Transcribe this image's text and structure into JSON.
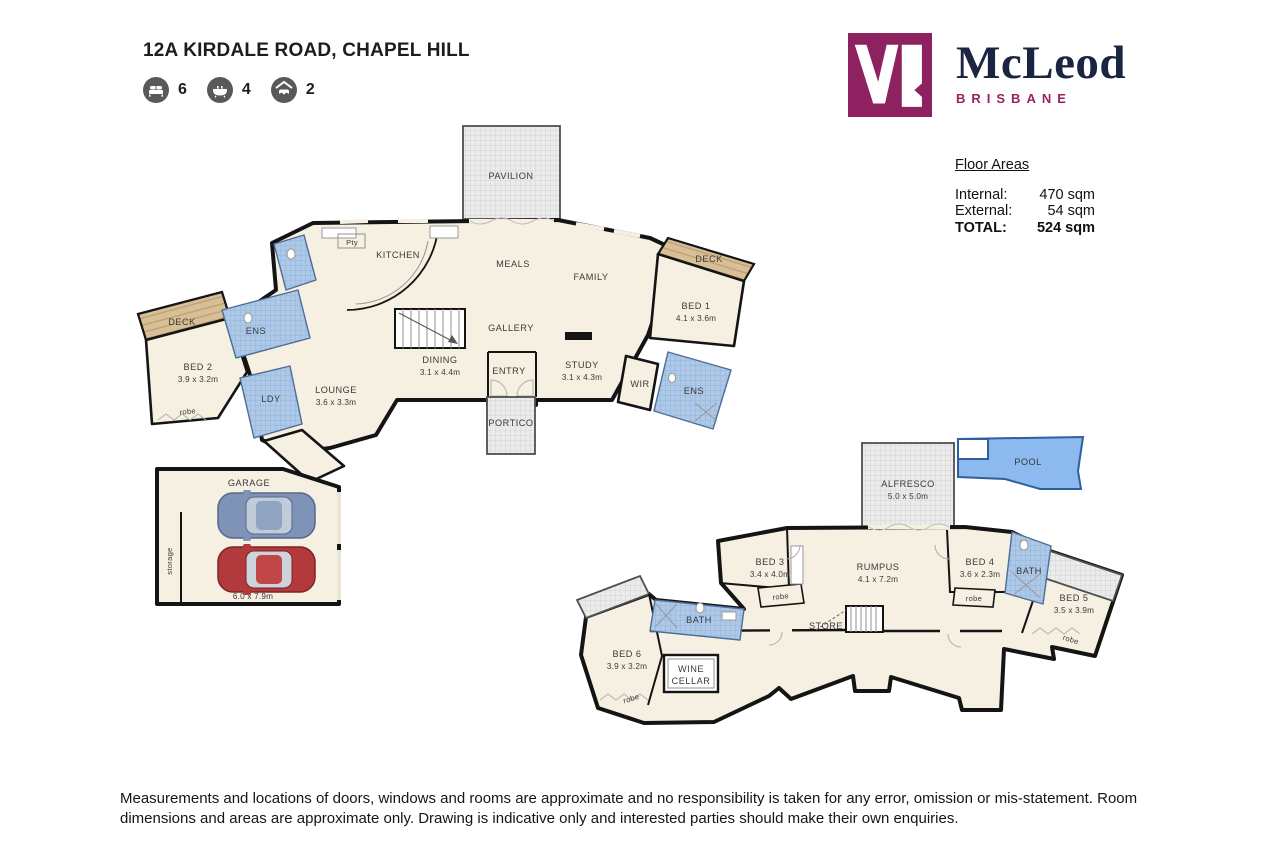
{
  "header": {
    "title": "12A KIRDALE ROAD, CHAPEL HILL",
    "stats": [
      {
        "icon": "bed-icon",
        "value": "6"
      },
      {
        "icon": "bath-icon",
        "value": "4"
      },
      {
        "icon": "car-icon",
        "value": "2"
      }
    ]
  },
  "logo": {
    "brand": "McLeod",
    "tagline": "BRISBANE"
  },
  "floor_areas": {
    "heading": "Floor Areas",
    "rows": [
      {
        "label": "Internal:",
        "value": "470 sqm"
      },
      {
        "label": "External:",
        "value": "54 sqm"
      },
      {
        "label": "TOTAL:",
        "value": "524 sqm"
      }
    ]
  },
  "plan": {
    "labels": {
      "robe": "robe",
      "deck": "DECK",
      "ens": "ENS",
      "bath": "BATH"
    },
    "upper": {
      "pavilion": "PAVILION",
      "kitchen": "KITCHEN",
      "pantry": "Pty",
      "meals": "MEALS",
      "family": "FAMILY",
      "gallery": "GALLERY",
      "dining": {
        "name": "DINING",
        "dims": "3.1 x 4.4m"
      },
      "entry": "ENTRY",
      "study": {
        "name": "STUDY",
        "dims": "3.1 x 4.3m"
      },
      "lounge": {
        "name": "LOUNGE",
        "dims": "3.6 x 3.3m"
      },
      "portico": "PORTICO",
      "ldy": "LDY",
      "wir": "WIR",
      "bed1": {
        "name": "BED 1",
        "dims": "4.1 x 3.6m"
      },
      "bed2": {
        "name": "BED 2",
        "dims": "3.9 x 3.2m"
      }
    },
    "garage": {
      "name": "GARAGE",
      "dims": "6.0 x 7.9m",
      "storage": "storage"
    },
    "lower": {
      "alfresco": {
        "name": "ALFRESCO",
        "dims": "5.0 x 5.0m"
      },
      "pool": "POOL",
      "rumpus": {
        "name": "RUMPUS",
        "dims": "4.1 x 7.2m"
      },
      "store": "STORE",
      "wine_cellar": {
        "line1": "WINE",
        "line2": "CELLAR"
      },
      "bed3": {
        "name": "BED 3",
        "dims": "3.4 x 4.0m"
      },
      "bed4": {
        "name": "BED 4",
        "dims": "3.6 x 2.3m"
      },
      "bed5": {
        "name": "BED 5",
        "dims": "3.5 x 3.9m"
      },
      "bed6": {
        "name": "BED 6",
        "dims": "3.9 x 3.2m"
      }
    }
  },
  "disclaimer": "Measurements and locations of doors, windows and rooms are approximate and no responsibility is taken for any error, omission or mis-statement. Room dimensions and areas are approximate only. Drawing is indicative only and interested parties should make their own enquiries.",
  "colors": {
    "brand_maroon": "#8E2160",
    "brand_navy": "#1B2440",
    "floor_cream": "#F6F0E2",
    "tile_blue": "#ADC9E7",
    "deck_tan": "#D9BF98",
    "pool_blue": "#8CB9EE",
    "wall_black": "#141414",
    "icon_gray": "#58595B"
  }
}
